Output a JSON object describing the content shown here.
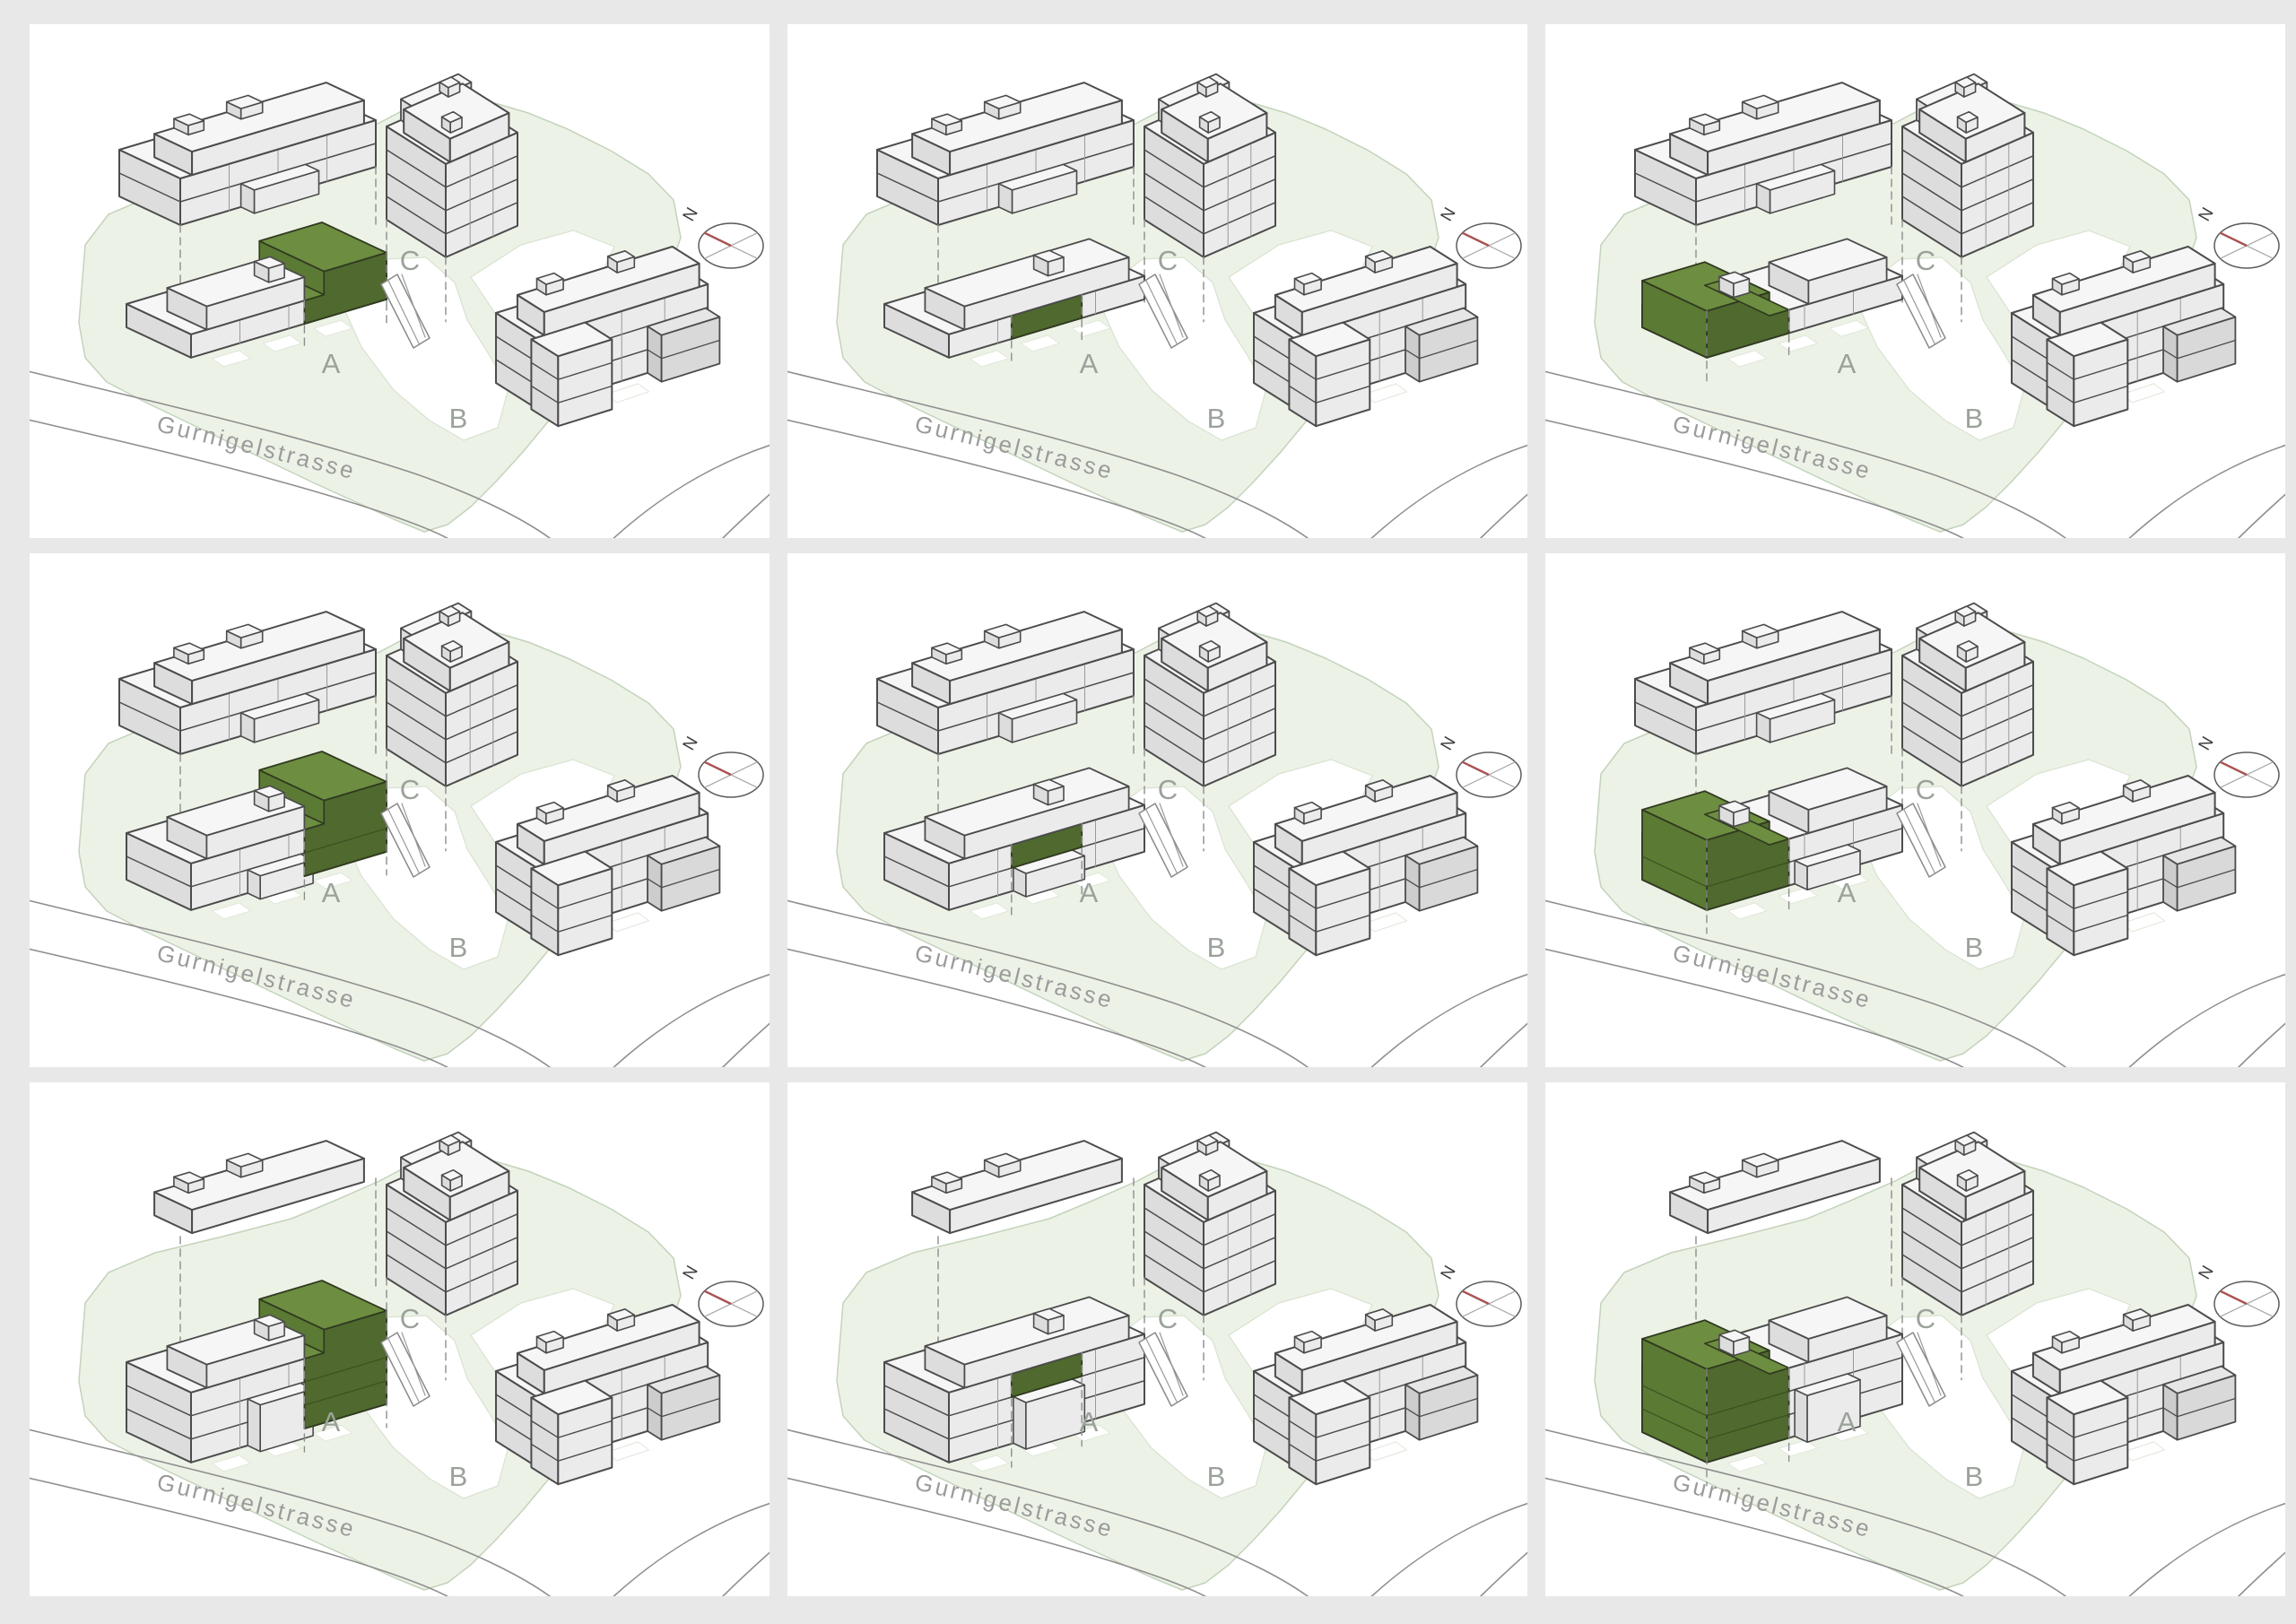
{
  "scene": {
    "street_name": "Gurnigelstrasse",
    "north_label": "N",
    "building_labels": {
      "a": "A",
      "b": "B",
      "c": "C"
    },
    "palette": {
      "page_bg": "#e8e8e8",
      "panel_bg": "#ffffff",
      "site_green": "#edf2e7",
      "site_green_border": "#c3d3bb",
      "path_white": "#ffffff",
      "building_roof": "#f6f6f6",
      "building_front": "#ebebeb",
      "building_side": "#dddddd",
      "terrace_roof": "#e6e6e6",
      "terrace_front": "#d9d9d9",
      "terrace_side": "#cdcdcd",
      "outline": "#4c4c4c",
      "highlight_top": "#6d8d40",
      "highlight_front": "#4f692e",
      "highlight_side": "#5b7a33",
      "highlight_outline": "#303a20",
      "highlight_line": "#3c5022",
      "label_gray": "#9aa29a",
      "street_line_gray": "#8f8f8f",
      "street_text_gray": "#9b9b9b",
      "dash_gray": "#8d8d8d",
      "compass_ring": "#5c5c5c",
      "compass_cross": "#a8a8a8",
      "compass_needle_red": "#a85252",
      "compass_n_color": "#3d3d3d"
    }
  },
  "panels": [
    {
      "grid_position": "row 1 / col 1",
      "highlighted_building": "A",
      "unit_span": "east",
      "level": "attic (top) floor",
      "front_slab_visible_floors": 1,
      "rear_slab_visible_floors": 2
    },
    {
      "grid_position": "row 1 / col 2",
      "highlighted_building": "A",
      "unit_span": "middle",
      "level": "attic (top) floor",
      "front_slab_visible_floors": 1,
      "rear_slab_visible_floors": 2
    },
    {
      "grid_position": "row 1 / col 3",
      "highlighted_building": "A",
      "unit_span": "west",
      "level": "attic (top) floor",
      "front_slab_visible_floors": 1,
      "rear_slab_visible_floors": 2
    },
    {
      "grid_position": "row 2 / col 1",
      "highlighted_building": "A",
      "unit_span": "east",
      "level": "upper floor",
      "front_slab_visible_floors": 2,
      "rear_slab_visible_floors": 2
    },
    {
      "grid_position": "row 2 / col 2",
      "highlighted_building": "A",
      "unit_span": "middle",
      "level": "upper floor",
      "front_slab_visible_floors": 2,
      "rear_slab_visible_floors": 2
    },
    {
      "grid_position": "row 2 / col 3",
      "highlighted_building": "A",
      "unit_span": "west",
      "level": "upper floor",
      "front_slab_visible_floors": 2,
      "rear_slab_visible_floors": 2
    },
    {
      "grid_position": "row 3 / col 1",
      "highlighted_building": "A",
      "unit_span": "east",
      "level": "lower floor",
      "front_slab_visible_floors": 3,
      "rear_slab_visible_floors": 0
    },
    {
      "grid_position": "row 3 / col 2",
      "highlighted_building": "A",
      "unit_span": "middle",
      "level": "lower floor",
      "front_slab_visible_floors": 3,
      "rear_slab_visible_floors": 0
    },
    {
      "grid_position": "row 3 / col 3",
      "highlighted_building": "A",
      "unit_span": "west",
      "level": "lower floor",
      "front_slab_visible_floors": 3,
      "rear_slab_visible_floors": 0
    }
  ]
}
